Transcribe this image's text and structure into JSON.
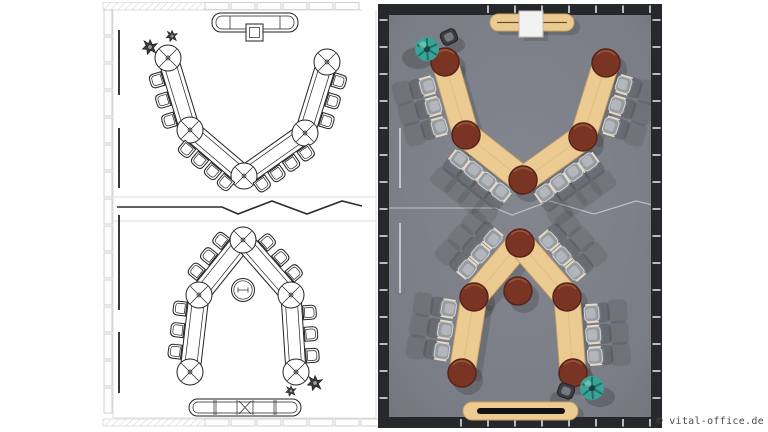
{
  "watermark": {
    "text": "© vital-office.de"
  },
  "scene": {
    "description": "Conference room furniture layout sheet: 2D CAD floor plan on the left, 3D top-down rendering on the right",
    "left_panel": "2d-cad-floor-plan",
    "right_panel": "3d-render-top-view",
    "arrangements": [
      {
        "name": "v-shape-conference-layout",
        "table_segments": 4,
        "round_link_tables": 5,
        "chairs": 14,
        "sideboard": 1,
        "lectern_screen": 1,
        "plants": 1,
        "side_chair": 1
      },
      {
        "name": "arch-conference-layout",
        "table_segments": 4,
        "round_link_tables": 5,
        "chairs": 12,
        "center_round_table": 1,
        "sideboard": 1,
        "plants": 1,
        "side_chair": 1
      }
    ]
  },
  "colors": {
    "floor": "#7b7e86",
    "wall": "#26282c",
    "wood": "#eccb92",
    "wood_edge": "#c8a263",
    "mahogany": "#7a3424",
    "mahogany_dark": "#57241a",
    "chair": "#989ba1",
    "chair_light": "#d3d4d7",
    "chair_dark": "#73767c",
    "plant": "#3aa296",
    "plant_dark": "#1f7169",
    "screen": "#f2f2f2",
    "cad_line": "#222222",
    "frame_line": "#c6c6c6",
    "watermark_text": "#4a4a4a"
  }
}
